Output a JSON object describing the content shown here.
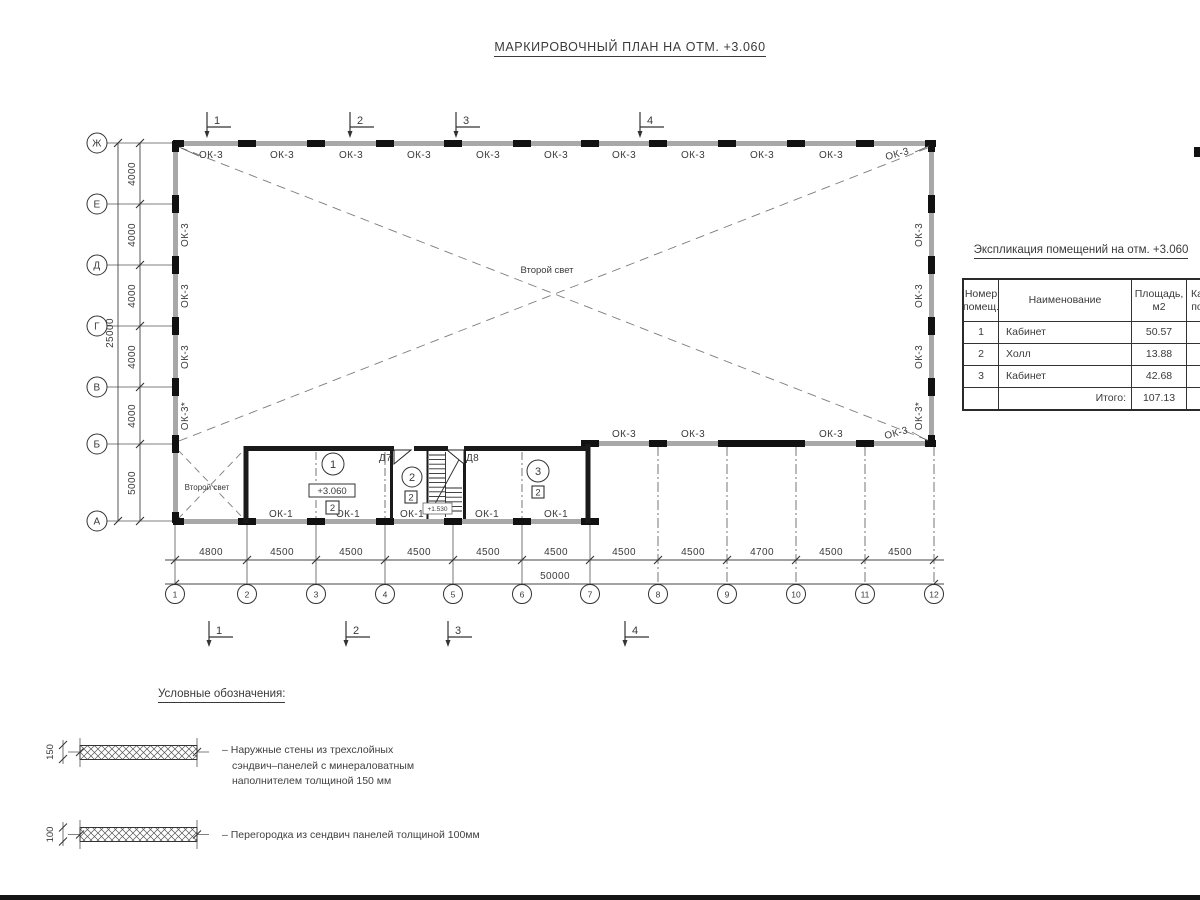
{
  "page": {
    "title": "МАРКИРОВОЧНЫЙ ПЛАН НА ОТМ. +3.060"
  },
  "plan": {
    "row_axes": [
      "Ж",
      "Е",
      "Д",
      "Г",
      "В",
      "Б",
      "А"
    ],
    "col_axes": [
      "1",
      "2",
      "3",
      "4",
      "5",
      "6",
      "7",
      "8",
      "9",
      "10",
      "11",
      "12"
    ],
    "left_dims": [
      "4000",
      "4000",
      "4000",
      "4000",
      "4000",
      "5000"
    ],
    "left_total": "25000",
    "bottom_dims": [
      "4800",
      "4500",
      "4500",
      "4500",
      "4500",
      "4500",
      "4500",
      "4500",
      "4700",
      "4500",
      "4500"
    ],
    "bottom_total": "50000",
    "section_marks": [
      "1",
      "2",
      "3",
      "4"
    ],
    "windows": {
      "top": [
        "ОК-3",
        "ОК-3",
        "ОК-3",
        "ОК-3",
        "ОК-3",
        "ОК-3",
        "ОК-3",
        "ОК-3",
        "ОК-3",
        "ОК-3",
        "ОК-3"
      ],
      "left": [
        "ОК-3",
        "ОК-3",
        "ОК-3",
        "ОК-3*"
      ],
      "right": [
        "ОК-3",
        "ОК-3",
        "ОК-3",
        "ОК-3*"
      ],
      "mid": [
        "ОК-3",
        "ОК-3",
        "ОК-3",
        "ОК-3"
      ],
      "bottom": [
        "ОК-1",
        "ОК-1",
        "ОК-1",
        "ОК-1",
        "ОК-1"
      ]
    },
    "second_light": "Второй свет",
    "doors": {
      "d7": "Д7",
      "d8": "Д8"
    },
    "rooms": [
      {
        "number": "1",
        "tag": "2",
        "elevation": "+3.060"
      },
      {
        "number": "2",
        "tag": "2"
      },
      {
        "number": "3",
        "tag": "2"
      }
    ],
    "stair_elevation": "+1.530"
  },
  "schedule": {
    "title": "Экспликация помещений на отм. +3.060",
    "headers": {
      "num_line1": "Номер",
      "num_line2": "помещ.",
      "name": "Наименование",
      "area_line1": "Площадь,",
      "area_line2": "м2",
      "cat_line1": "Ка",
      "cat_line2": "по"
    },
    "rows": [
      {
        "num": "1",
        "name": "Кабинет",
        "area": "50.57"
      },
      {
        "num": "2",
        "name": "Холл",
        "area": "13.88"
      },
      {
        "num": "3",
        "name": "Кабинет",
        "area": "42.68"
      }
    ],
    "total_label": "Итого:",
    "total_area": "107.13"
  },
  "legend": {
    "title": "Условные обозначения:",
    "items": [
      {
        "thickness": "150",
        "line1": "– Наружные стены из трехслойных",
        "line2": "сэндвич–панелей с минераловатным",
        "line3": "наполнителем толщиной 150 мм"
      },
      {
        "thickness": "100",
        "line1": "– Перегородка из сендвич панелей толщиной 100мм"
      }
    ]
  }
}
